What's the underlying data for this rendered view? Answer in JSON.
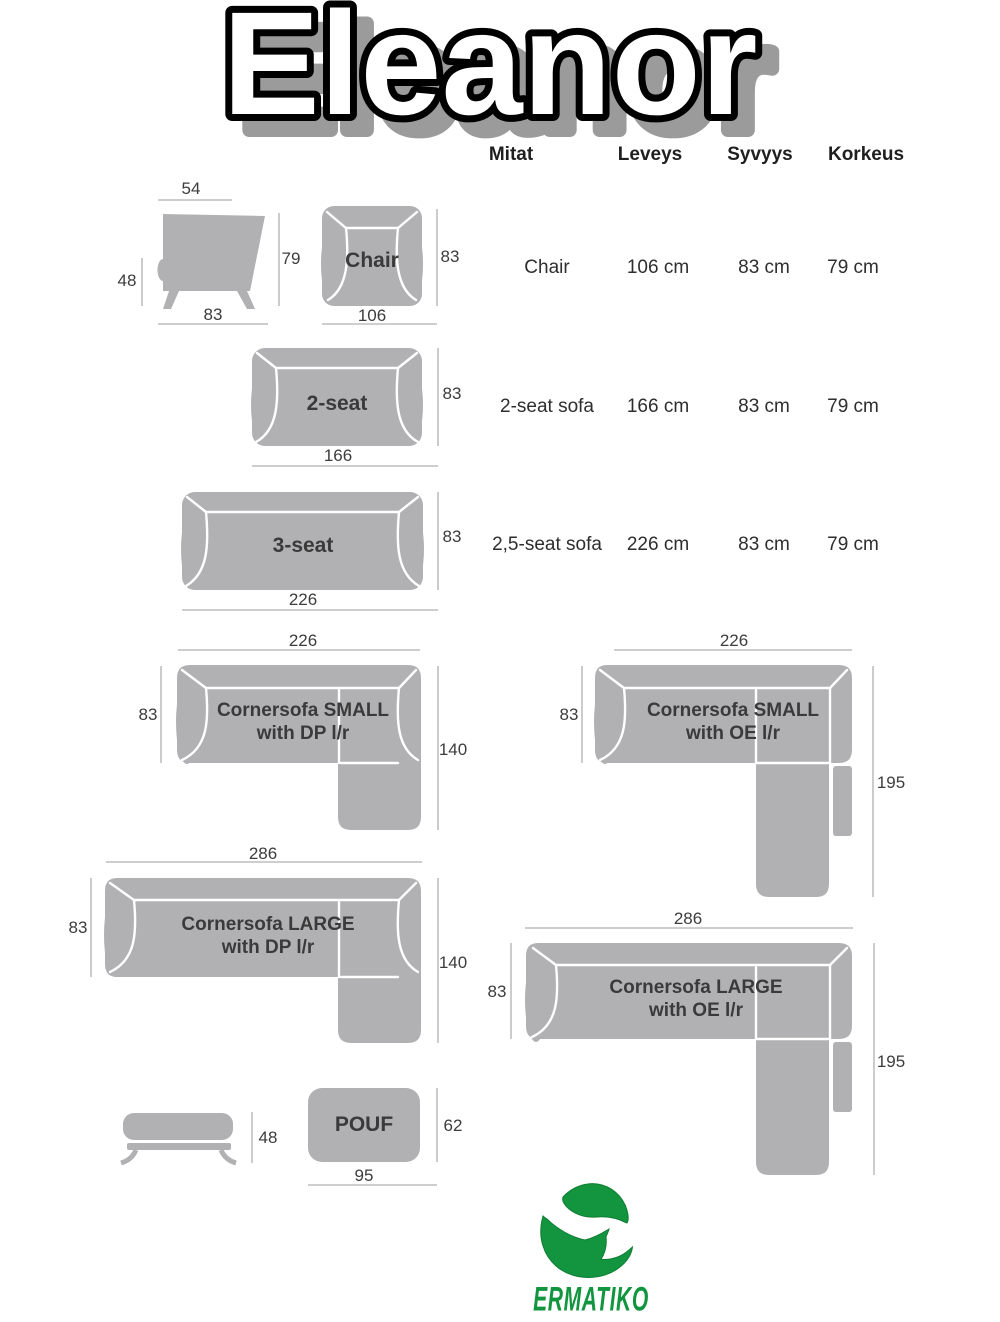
{
  "title": "Eleanor",
  "table": {
    "headers": [
      "Mitat",
      "Leveys",
      "Syvyys",
      "Korkeus"
    ],
    "rows": [
      {
        "name": "Chair",
        "leveys": "106 cm",
        "syvyys": "83 cm",
        "korkeus": "79 cm"
      },
      {
        "name": "2-seat sofa",
        "leveys": "166 cm",
        "syvyys": "83 cm",
        "korkeus": "79 cm"
      },
      {
        "name": "2,5-seat sofa",
        "leveys": "226 cm",
        "syvyys": "83 cm",
        "korkeus": "79 cm"
      }
    ]
  },
  "diagrams": {
    "chair_side": {
      "top": "54",
      "left": "48",
      "right": "79",
      "bottom": "83"
    },
    "chair_top": {
      "label": "Chair",
      "right": "83",
      "bottom": "106"
    },
    "two_seat": {
      "label": "2-seat",
      "right": "83",
      "bottom": "166"
    },
    "three_seat": {
      "label": "3-seat",
      "right": "83",
      "bottom": "226"
    },
    "corner_small_dp": {
      "label1": "Cornersofa SMALL",
      "label2": "with DP l/r",
      "top": "226",
      "left": "83",
      "right": "140"
    },
    "corner_small_oe": {
      "label1": "Cornersofa SMALL",
      "label2": "with OE l/r",
      "top": "226",
      "left": "83",
      "right": "195"
    },
    "corner_large_dp": {
      "label1": "Cornersofa LARGE",
      "label2": "with DP l/r",
      "top": "286",
      "left": "83",
      "right": "140"
    },
    "corner_large_oe": {
      "label1": "Cornersofa LARGE",
      "label2": "with OE l/r",
      "top": "286",
      "left": "83",
      "right": "195"
    },
    "pouf_side": {
      "right": "48"
    },
    "pouf_top": {
      "label": "POUF",
      "right": "62",
      "bottom": "95"
    }
  },
  "logo": {
    "text": "ERMATIKO"
  },
  "colors": {
    "sofa_gray": "#b1b1b4",
    "seam_white": "#ffffff",
    "dim_line_gray": "#b0b0b0",
    "logo_green": "#12953e",
    "title_shadow_gray": "#9b9b9b"
  }
}
